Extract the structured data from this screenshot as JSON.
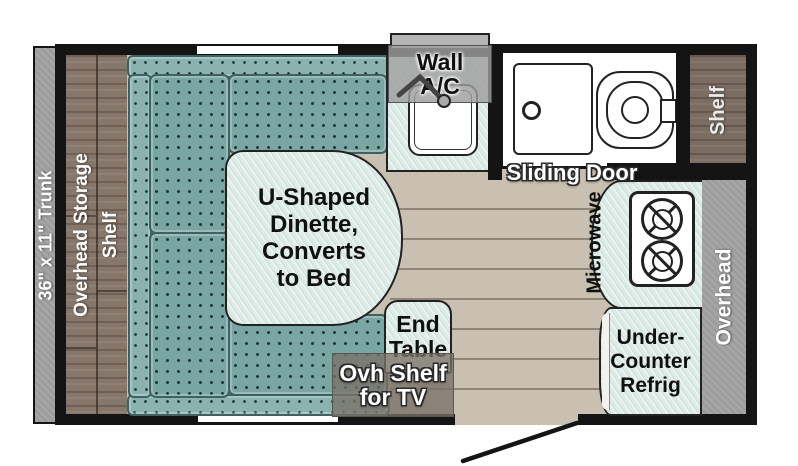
{
  "diagram_type": "travel-trailer floor plan",
  "labels": {
    "trunk": "36\" x 11\" Trunk",
    "overhead_storage": "Overhead Storage",
    "storage_shelf": "Shelf",
    "wall_ac": [
      "Wall",
      "A/C"
    ],
    "sliding_door": "Sliding Door",
    "right_shelf": "Shelf",
    "dinette": [
      "U-Shaped",
      "Dinette,",
      "Converts",
      "to Bed"
    ],
    "end_table": [
      "End",
      "Table"
    ],
    "ovh_shelf_tv": [
      "Ovh Shelf",
      "for TV"
    ],
    "microwave": "Microwave",
    "overhead": "Overhead",
    "under_counter_refrig": [
      "Under-",
      "Counter",
      "Refrig"
    ]
  },
  "fixtures": [
    "sink",
    "faucet",
    "toilet",
    "shower-sliding-panel",
    "two-burner-cooktop",
    "entry-door-swing"
  ],
  "colors": {
    "wall": "#141414",
    "floor_tan": "#c9c0b1",
    "cushion_teal": "#79a5a2",
    "counter_mint": "#dcebe6",
    "wood_brown": "#87776b",
    "gray_bar": "#9d9d9d"
  }
}
